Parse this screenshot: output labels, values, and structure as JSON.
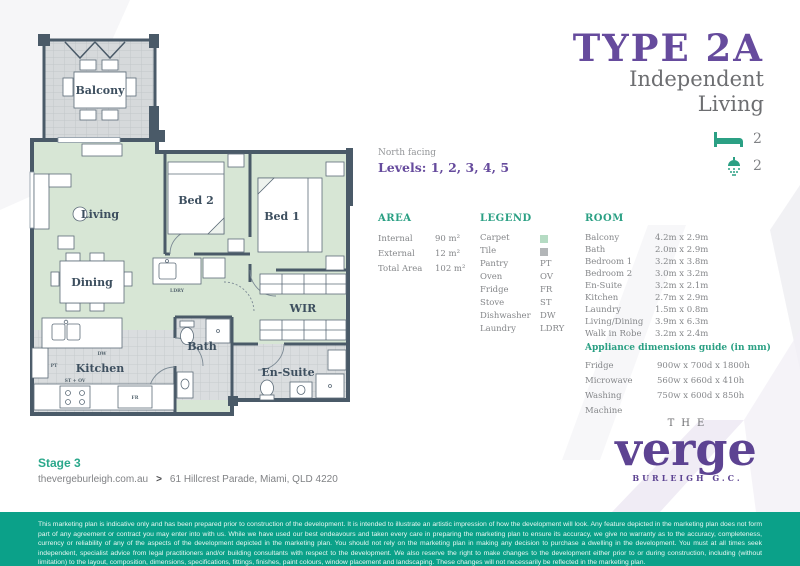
{
  "title": {
    "type": "TYPE 2A",
    "subtitle_line1": "Independent",
    "subtitle_line2": "Living",
    "bedrooms": "2",
    "bathrooms": "2"
  },
  "plan_info": {
    "facing": "North facing",
    "levels": "Levels: 1, 2, 3, 4, 5"
  },
  "area": {
    "heading": "AREA",
    "rows": [
      {
        "label": "Internal",
        "value": "90 m²"
      },
      {
        "label": "External",
        "value": "12 m²"
      },
      {
        "label": "Total Area",
        "value": "102 m²"
      }
    ]
  },
  "legend": {
    "heading": "LEGEND",
    "rows": [
      {
        "label": "Carpet",
        "value": "",
        "swatch": "carpet"
      },
      {
        "label": "Tile",
        "value": "",
        "swatch": "tile"
      },
      {
        "label": "Pantry",
        "value": "PT"
      },
      {
        "label": "Oven",
        "value": "OV"
      },
      {
        "label": "Fridge",
        "value": "FR"
      },
      {
        "label": "Stove",
        "value": "ST"
      },
      {
        "label": "Dishwasher",
        "value": "DW"
      },
      {
        "label": "Laundry",
        "value": "LDRY"
      }
    ]
  },
  "room": {
    "heading": "ROOM",
    "rows": [
      {
        "label": "Balcony",
        "value": "4.2m x 2.9m"
      },
      {
        "label": "Bath",
        "value": "2.0m x 2.9m"
      },
      {
        "label": "Bedroom 1",
        "value": "3.2m x 3.8m"
      },
      {
        "label": "Bedroom 2",
        "value": "3.0m x 3.2m"
      },
      {
        "label": "En-Suite",
        "value": "3.2m x 2.1m"
      },
      {
        "label": "Kitchen",
        "value": "2.7m x 2.9m"
      },
      {
        "label": "Laundry",
        "value": "1.5m x 0.8m"
      },
      {
        "label": "Living/Dining",
        "value": "3.9m x 6.3m"
      },
      {
        "label": "Walk in Robe",
        "value": "3.2m x 2.4m"
      }
    ]
  },
  "appliances": {
    "heading": "Appliance dimensions guide (in mm)",
    "rows": [
      {
        "label": "Fridge",
        "value": "900w x 700d x 1800h"
      },
      {
        "label": "Microwave",
        "value": "560w x 660d x 410h"
      },
      {
        "label": "Washing Machine",
        "value": "750w x 600d x 850h"
      }
    ]
  },
  "floorplan": {
    "balcony": "Balcony",
    "living": "Living",
    "bed2": "Bed 2",
    "bed1": "Bed 1",
    "dining": "Dining",
    "wir": "WIR",
    "bath": "Bath",
    "ensuite": "En-Suite",
    "kitchen": "Kitchen",
    "ldry": "LDRY",
    "dw": "DW",
    "pt": "PT",
    "fr": "FR",
    "st_ov": "ST + OV"
  },
  "footer": {
    "stage": "Stage 3",
    "website": "thevergeburleigh.com.au",
    "separator": ">",
    "address": "61 Hillcrest Parade, Miami, QLD 4220"
  },
  "logo": {
    "the": "THE",
    "name": "verge",
    "location": "BURLEIGH G.C."
  },
  "disclaimer": "This marketing plan is indicative only and has been prepared prior to construction of the development. It is intended to illustrate an artistic impression of how the development will look. Any feature depicted in the marketing plan does not form part of any agreement or contract you may enter into with us. While we have used our best endeavours and taken every care in preparing the marketing plan to ensure its accuracy, we give no warranty as to the accuracy, completeness, currency or reliability of any of the aspects of the development depicted in the marketing plan. You should not rely on the marketing plan in making any decision to purchase a dwelling in the development. You must at all times seek independent, specialist advice from legal practitioners and/or building consultants with respect to the development. We also reserve the right to make changes to the development either prior to or during construction, including (without limitation) to the layout, composition, dimensions, specifications, fittings, finishes, paint colours, window placement and landscaping. These changes will not necessarily be reflected in the marketing plan.",
  "colors": {
    "purple": "#664b9d",
    "logo_purple": "#5d4392",
    "accent_green": "#2ba084",
    "stage_green": "#2aa88b",
    "disclaimer_bg": "#0ba189",
    "wall": "#4a5a68",
    "carpet": "#d7e6d5",
    "tile": "#d9dcde"
  }
}
